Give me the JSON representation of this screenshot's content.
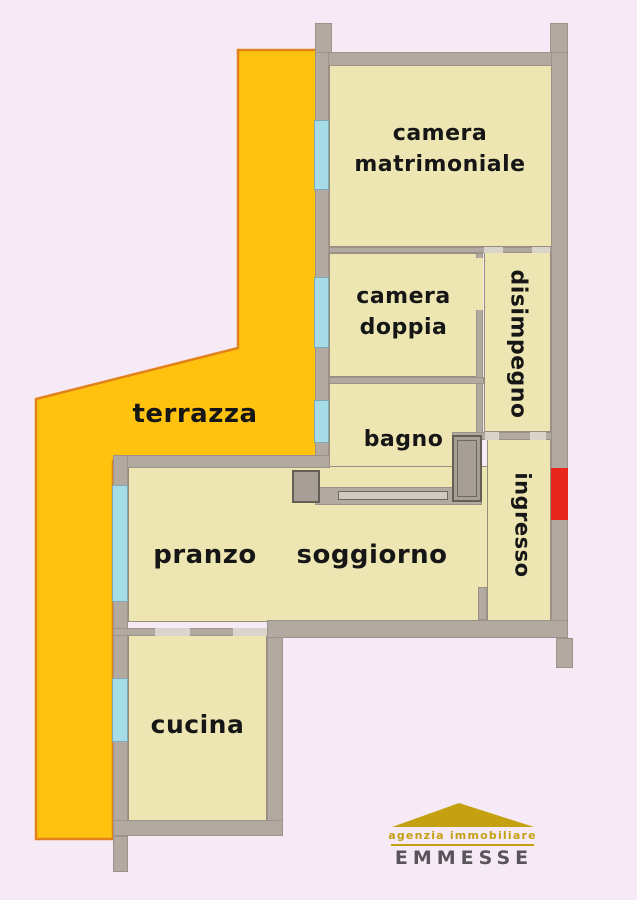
{
  "plan": {
    "rooms": {
      "camera_matrimoniale": {
        "line1": "camera",
        "line2": "matrimoniale"
      },
      "camera_doppia": {
        "line1": "camera",
        "line2": "doppia"
      },
      "disimpegno": {
        "label": "disimpegno"
      },
      "bagno": {
        "label": "bagno"
      },
      "ingresso": {
        "label": "ingresso"
      },
      "pranzo": {
        "label": "pranzo"
      },
      "soggiorno": {
        "label": "soggiorno"
      },
      "cucina": {
        "label": "cucina"
      },
      "terrazza": {
        "label": "terrazza"
      }
    }
  },
  "logo": {
    "tagline": "agenzia  immobiliare",
    "name": "EMMESSE"
  },
  "colors": {
    "background": "#f6eaf6",
    "terrace": "#ffc30f",
    "terrace_border": "#e2821c",
    "wall": "#b2a9a1",
    "wall_light": "#d9d5cd",
    "room": "#ede6b2",
    "window": "#a6dbe8",
    "door_red": "#e8251c",
    "label_text": "#161616",
    "logo_gold": "#c5a112",
    "logo_text": "#59545a"
  }
}
